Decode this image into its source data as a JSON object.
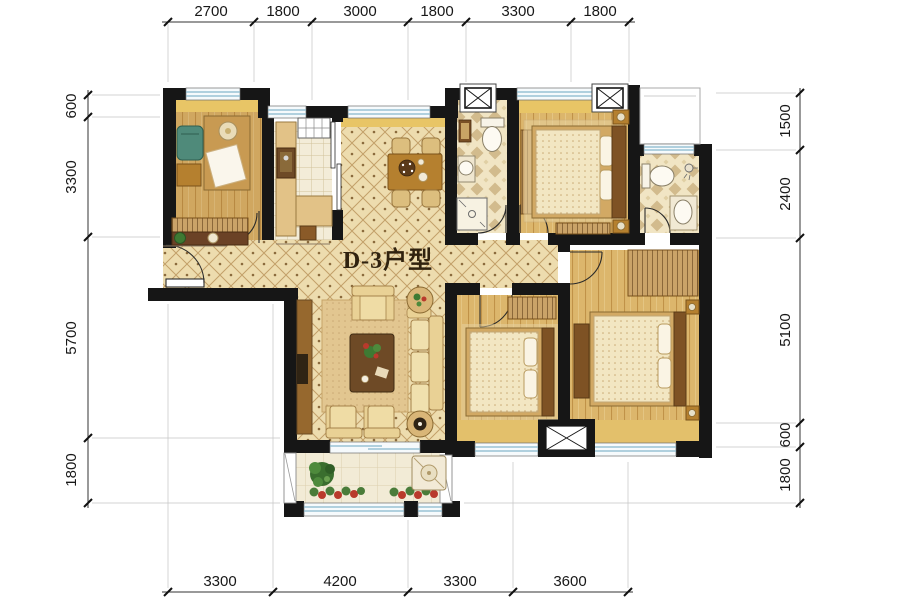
{
  "unit": {
    "label": "D-3户型"
  },
  "dimensions": {
    "top": [
      "2700",
      "1800",
      "3000",
      "1800",
      "3300",
      "1800"
    ],
    "bottom": [
      "3300",
      "4200",
      "3300",
      "3600"
    ],
    "left": [
      "600",
      "3300",
      "5700",
      "1800"
    ],
    "right": [
      "1500",
      "2400",
      "5100",
      "600",
      "1800"
    ]
  },
  "colors": {
    "wall": "#161616",
    "hall_tile": "#eddcae",
    "lattice": "#c2a069",
    "wood_floor": "#dcb66c",
    "accent_band": "#e8c566",
    "window_blue": "#86b7cb",
    "dim_text": "#181818"
  }
}
